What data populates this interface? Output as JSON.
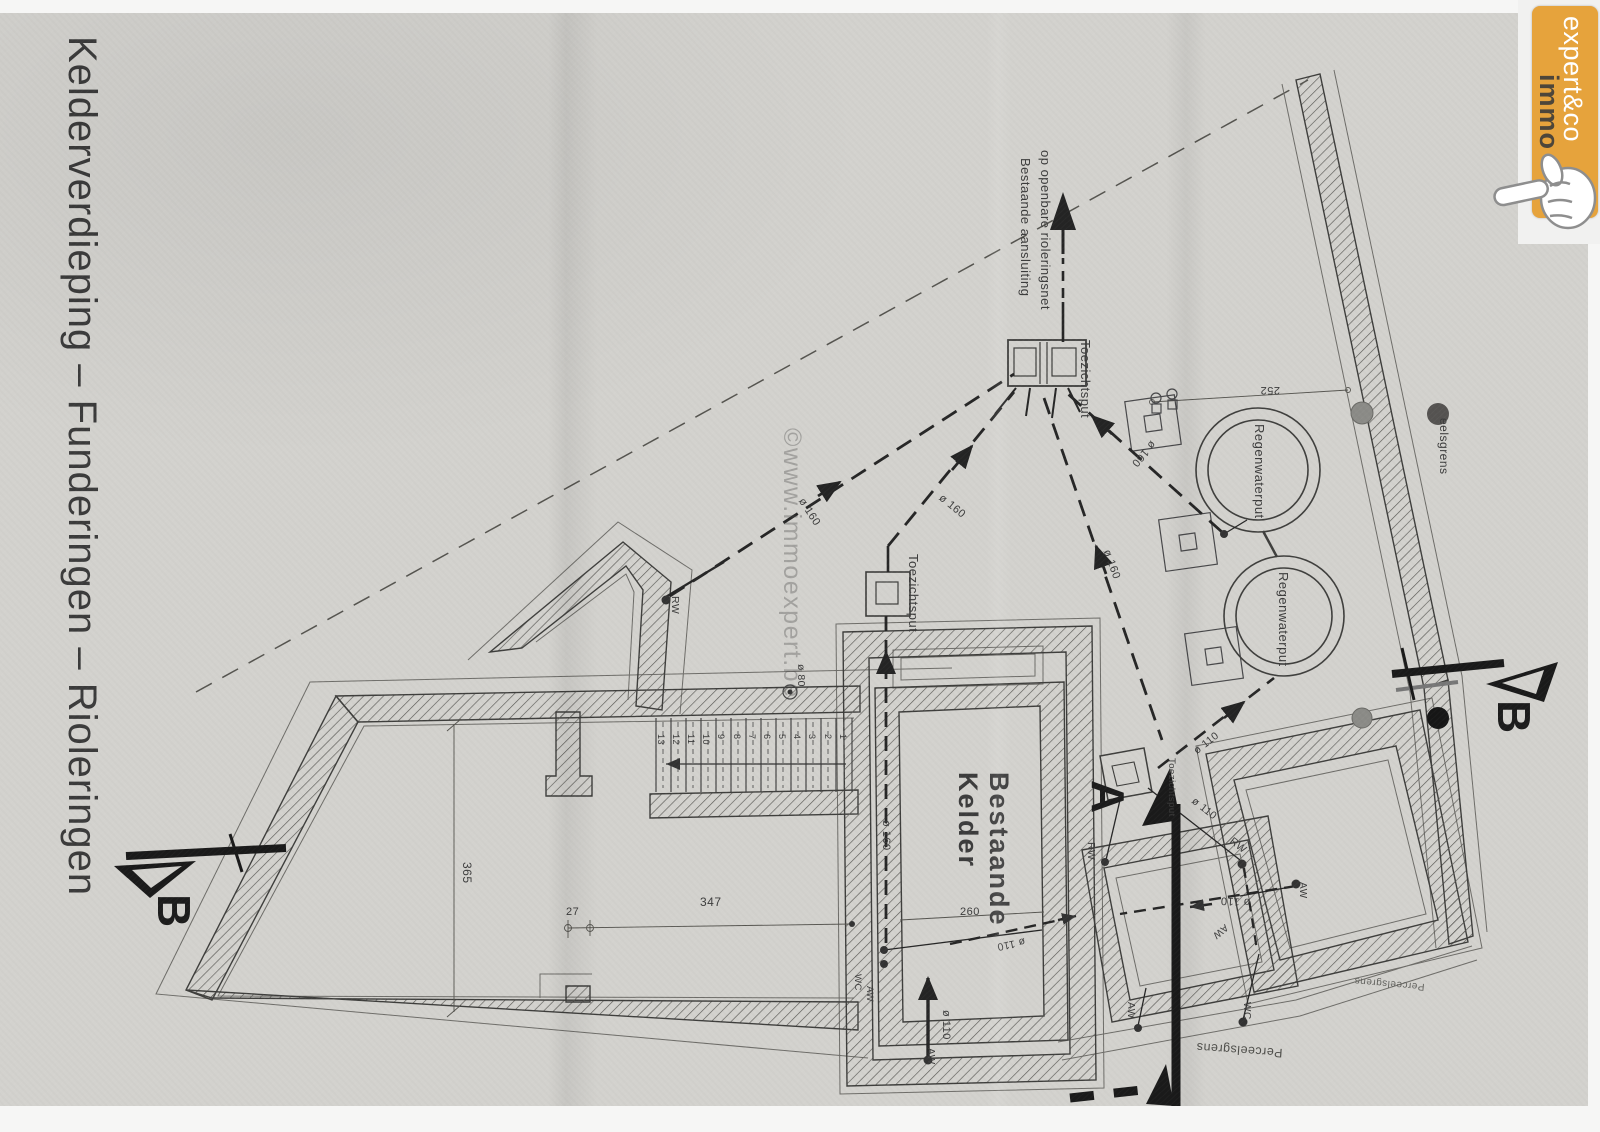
{
  "document": {
    "title": "Kelderverdieping  –  Funderingen  –  Rioleringen"
  },
  "watermark": {
    "text": "©www.immoexpert.be"
  },
  "logo": {
    "word1": "immo",
    "word2": "expert&co",
    "bg_color": "#e6a33c",
    "word1_color": "#4d463a",
    "word2_color": "#ffffff"
  },
  "colors": {
    "paper": "#d3d2ce",
    "ink": "#3c3c3c",
    "section_ink": "#1a1a1a",
    "accent": "#e6a33c"
  },
  "plan": {
    "labels": [
      {
        "text": "Bestaande aansluiting",
        "x": 1032,
        "y": 158,
        "rot": 90,
        "size": 13
      },
      {
        "text": "op openbare rioleringsnet",
        "x": 1052,
        "y": 150,
        "rot": 90,
        "size": 13
      },
      {
        "text": "Toezichtsput",
        "x": 1092,
        "y": 340,
        "rot": 90,
        "size": 13
      },
      {
        "text": "Toezichtsput",
        "x": 920,
        "y": 554,
        "rot": 90,
        "size": 13
      },
      {
        "text": "Toezichtsput",
        "x": 1176,
        "y": 758,
        "rot": 90,
        "size": 9.5
      },
      {
        "text": "Regenwaterput",
        "x": 1266,
        "y": 424,
        "rot": 90,
        "size": 13
      },
      {
        "text": "Regenwaterput",
        "x": 1290,
        "y": 572,
        "rot": 90,
        "size": 13
      },
      {
        "text": "eelsgrens",
        "x": 1450,
        "y": 418,
        "rot": 90,
        "size": 12
      },
      {
        "text": "252",
        "x": 1280,
        "y": 396,
        "rot": 180,
        "size": 11
      },
      {
        "text": "365",
        "x": 473,
        "y": 862,
        "rot": 90,
        "size": 12
      },
      {
        "text": "27",
        "x": 566,
        "y": 906,
        "rot": 0,
        "size": 11
      },
      {
        "text": "347",
        "x": 700,
        "y": 896,
        "rot": 0,
        "size": 12
      },
      {
        "text": "260",
        "x": 960,
        "y": 906,
        "rot": 0,
        "size": 11
      },
      {
        "text": "Bestaande\nKelder",
        "x": 1014,
        "y": 772,
        "rot": 90,
        "size": 27,
        "weight": 600,
        "ls": 2
      },
      {
        "text": "ø 160",
        "x": 806,
        "y": 496,
        "rot": 57,
        "size": 11
      },
      {
        "text": "ø 160",
        "x": 944,
        "y": 492,
        "rot": 39,
        "size": 11
      },
      {
        "text": "ø 160",
        "x": 1158,
        "y": 446,
        "rot": 131,
        "size": 11
      },
      {
        "text": "ø 160",
        "x": 1112,
        "y": 548,
        "rot": 70,
        "size": 11
      },
      {
        "text": "ø 160",
        "x": 892,
        "y": 820,
        "rot": 90,
        "size": 11
      },
      {
        "text": "ø 80",
        "x": 806,
        "y": 664,
        "rot": 90,
        "size": 10.5
      },
      {
        "text": "ø 110",
        "x": 1196,
        "y": 796,
        "rot": 38,
        "size": 10.5
      },
      {
        "text": "RW",
        "x": 1234,
        "y": 836,
        "rot": 38,
        "size": 10.5
      },
      {
        "text": "RW",
        "x": 1096,
        "y": 842,
        "rot": 90,
        "size": 10.5
      },
      {
        "text": "RW",
        "x": 680,
        "y": 596,
        "rot": 90,
        "size": 10.5
      },
      {
        "text": "ø 110",
        "x": 1192,
        "y": 748,
        "rot": -38,
        "size": 10.5
      },
      {
        "text": "ø 110",
        "x": 1250,
        "y": 908,
        "rot": 183,
        "size": 11
      },
      {
        "text": "AW",
        "x": 1230,
        "y": 930,
        "rot": 140,
        "size": 10
      },
      {
        "text": "ø 110",
        "x": 1026,
        "y": 946,
        "rot": 168,
        "size": 10.5
      },
      {
        "text": "ø 110",
        "x": 952,
        "y": 1010,
        "rot": 90,
        "size": 11
      },
      {
        "text": "AW",
        "x": 936,
        "y": 1048,
        "rot": 90,
        "size": 10
      },
      {
        "text": "WC",
        "x": 862,
        "y": 974,
        "rot": 90,
        "size": 9.5
      },
      {
        "text": "AW",
        "x": 874,
        "y": 986,
        "rot": 90,
        "size": 9.5
      },
      {
        "text": "AW",
        "x": 1308,
        "y": 882,
        "rot": 90,
        "size": 10
      },
      {
        "text": "WC",
        "x": 1252,
        "y": 1002,
        "rot": 90,
        "size": 10
      },
      {
        "text": "AW",
        "x": 1136,
        "y": 1002,
        "rot": 90,
        "size": 10
      },
      {
        "text": "Perceelsgrens",
        "x": 1282,
        "y": 1060,
        "rot": 184,
        "size": 12.5,
        "color": "#4e4e4a"
      },
      {
        "text": "Perceelsgrens",
        "x": 1424,
        "y": 992,
        "rot": 185,
        "size": 10,
        "color": "#62625e"
      },
      {
        "text": "A",
        "x": 1134,
        "y": 780,
        "rot": 90,
        "size": 46,
        "weight": 700,
        "color": "#1c1c1c"
      },
      {
        "text": "B",
        "x": 200,
        "y": 894,
        "rot": 90,
        "size": 46,
        "weight": 700,
        "color": "#1c1c1c"
      },
      {
        "text": "B",
        "x": 1540,
        "y": 700,
        "rot": 90,
        "size": 46,
        "weight": 700,
        "color": "#1c1c1c"
      },
      {
        "text": "13",
        "x": 666,
        "y": 734,
        "rot": 90,
        "size": 9
      },
      {
        "text": "12",
        "x": 681,
        "y": 734,
        "rot": 90,
        "size": 9
      },
      {
        "text": "11",
        "x": 696,
        "y": 734,
        "rot": 90,
        "size": 9
      },
      {
        "text": "10",
        "x": 711,
        "y": 734,
        "rot": 90,
        "size": 9
      },
      {
        "text": "9",
        "x": 726,
        "y": 734,
        "rot": 90,
        "size": 9
      },
      {
        "text": "8",
        "x": 742,
        "y": 734,
        "rot": 90,
        "size": 9
      },
      {
        "text": "7",
        "x": 757,
        "y": 734,
        "rot": 90,
        "size": 9
      },
      {
        "text": "6",
        "x": 772,
        "y": 734,
        "rot": 90,
        "size": 9
      },
      {
        "text": "5",
        "x": 787,
        "y": 734,
        "rot": 90,
        "size": 9
      },
      {
        "text": "4",
        "x": 802,
        "y": 734,
        "rot": 90,
        "size": 9
      },
      {
        "text": "3",
        "x": 817,
        "y": 734,
        "rot": 90,
        "size": 9
      },
      {
        "text": "2",
        "x": 833,
        "y": 734,
        "rot": 90,
        "size": 9
      },
      {
        "text": "1",
        "x": 848,
        "y": 734,
        "rot": 90,
        "size": 9
      }
    ]
  }
}
